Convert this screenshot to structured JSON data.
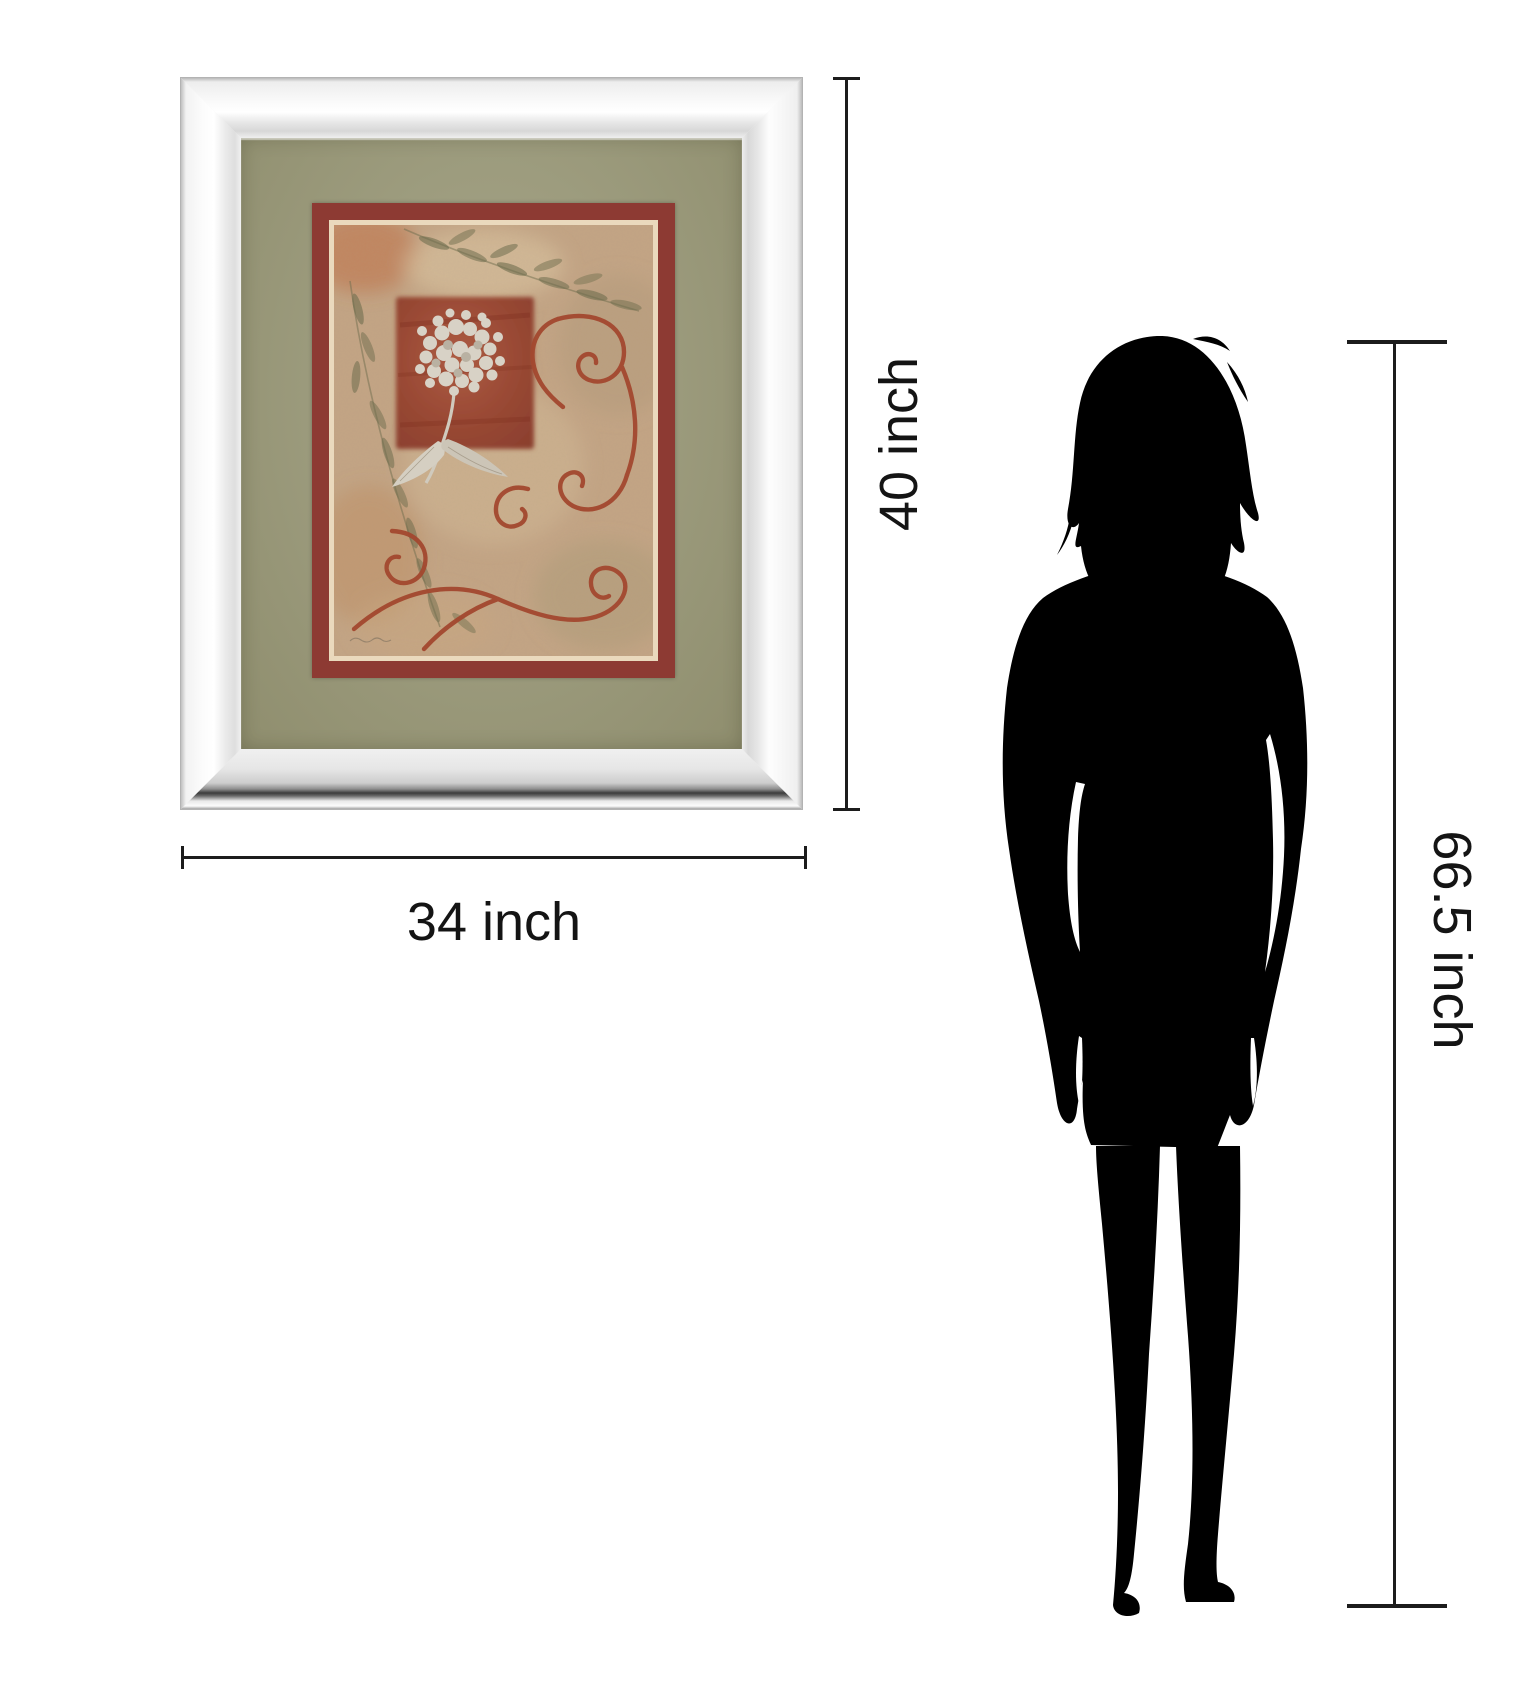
{
  "title": "Framed wall art size comparison",
  "artwork": {
    "frame_style": "mirror-frame",
    "mat_color": "#9a9979",
    "border_color": "#8d3a33",
    "pinstripe_color": "#ead9bd",
    "print_background": "#c3a484",
    "accent_square_color": "#964632",
    "swirl_color": "#a3482f",
    "leaf_color": "#6f6e4e",
    "flower_color": "#d8d2c6"
  },
  "measurements": {
    "frame_height": {
      "label": "40 inch",
      "value": 40,
      "unit": "inch"
    },
    "frame_width": {
      "label": "34 inch",
      "value": 34,
      "unit": "inch"
    },
    "person_height": {
      "label": "66.5 inch",
      "value": 66.5,
      "unit": "inch"
    }
  },
  "figure": {
    "type": "woman silhouette",
    "color": "#000000"
  }
}
